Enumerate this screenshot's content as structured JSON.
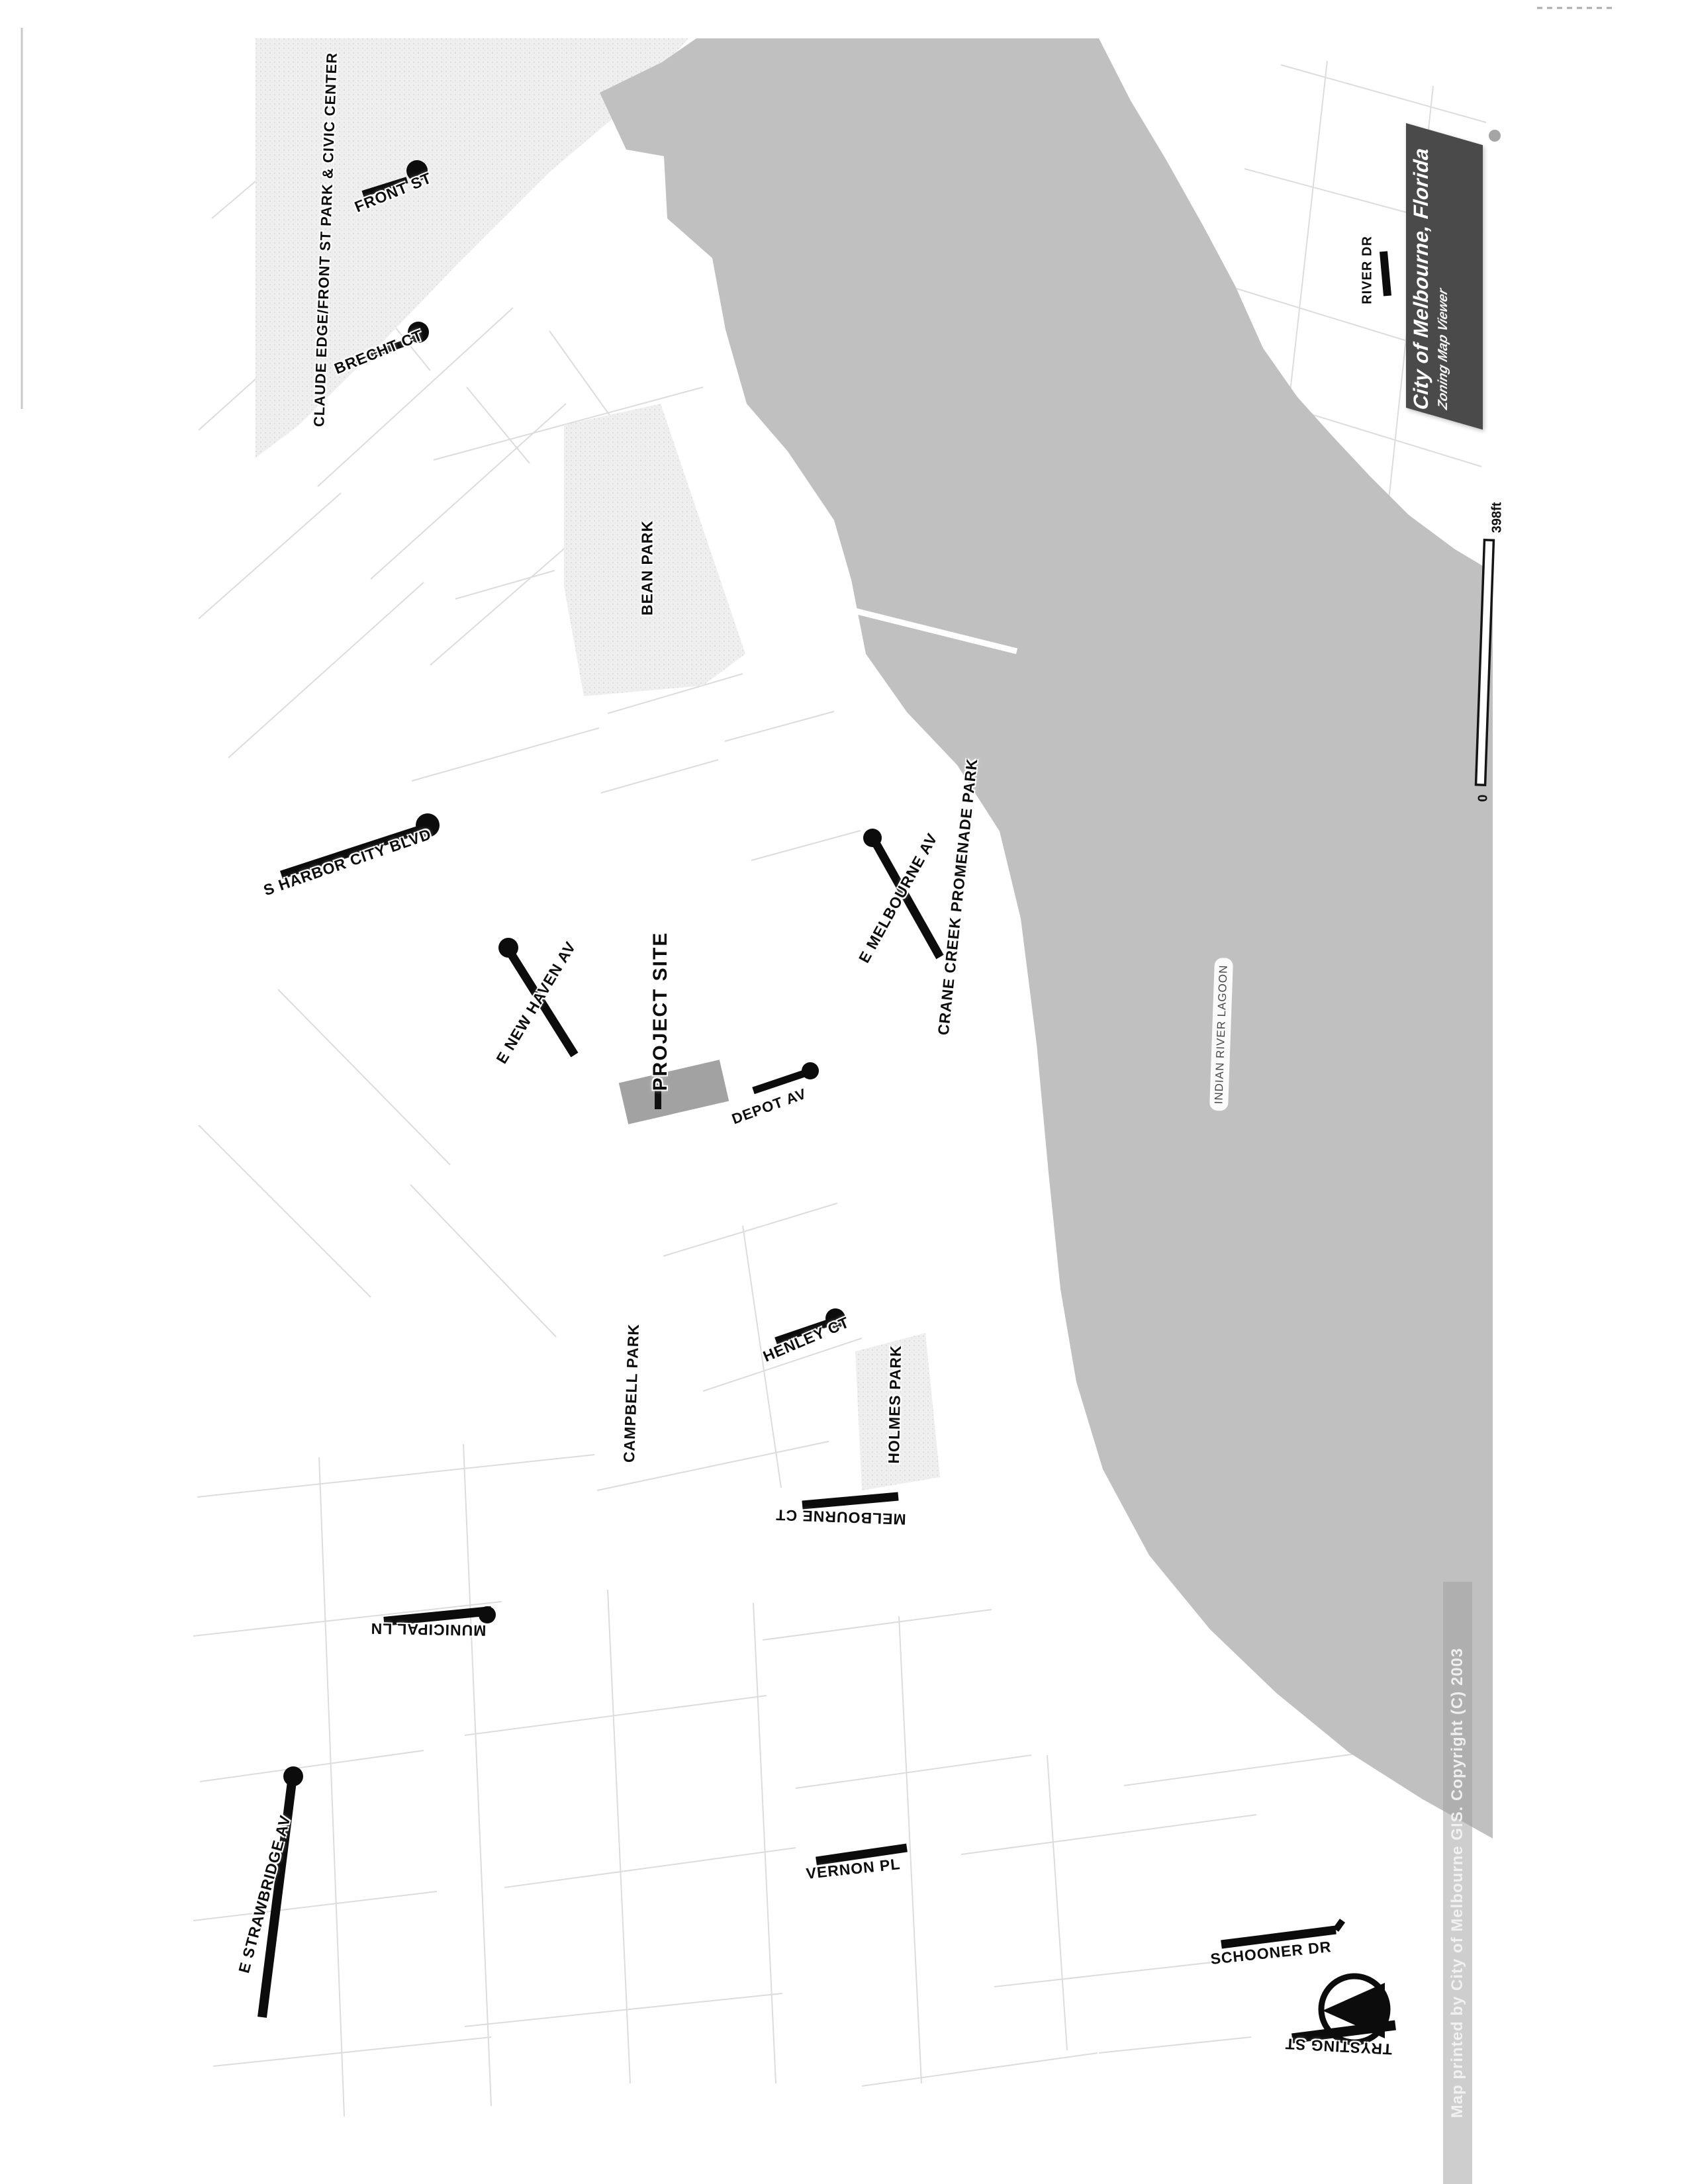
{
  "title": {
    "line1": "City of Melbourne, Florida",
    "line2": "Zoning Map Viewer"
  },
  "scale_bar": {
    "max_label": "398ft",
    "min_label": "0"
  },
  "copyright_note": "Map printed by City of Melbourne GIS. Copyright (C) 2003",
  "icons": {
    "north_arrow": "compass-circle-with-left-triangle"
  },
  "labels": {
    "claude_edge_park": "CLAUDE EDGE/FRONT ST PARK & CIVIC CENTER",
    "front_st": "FRONT ST",
    "brecht_ct": "BRECHT CT",
    "bean_park": "BEAN PARK",
    "s_harbor_city_blvd": "S HARBOR CITY BLVD",
    "e_new_haven_av": "E NEW HAVEN AV",
    "project_site": "PROJECT SITE",
    "depot_av": "DEPOT AV",
    "e_melbourne_av": "E MELBOURNE AV",
    "crane_creek_promenade_park": "CRANE CREEK PROMENADE PARK",
    "indian_river_lagoon": "INDIAN RIVER LAGOON",
    "river_dr": "RIVER DR",
    "campbell_park": "CAMPBELL PARK",
    "henley_ct": "HENLEY CT",
    "holmes_park": "HOLMES PARK",
    "melbourne_ct": "MELBOURNE CT",
    "municipal_ln": "MUNICIPAL LN",
    "e_strawbridge_av": "E STRAWBRIDGE AV",
    "vernon_pl": "VERNON PL",
    "schooner_dr": "SCHOONER DR",
    "trysting_st": "TRYSTING ST"
  },
  "colors": {
    "water": "#c0c0c0",
    "park_base": "#efefef",
    "project_site": "#a2a2a2",
    "title_bg": "#4a4a4a",
    "street": "#0c0c0c",
    "parcel_line": "#dcdcdc"
  }
}
